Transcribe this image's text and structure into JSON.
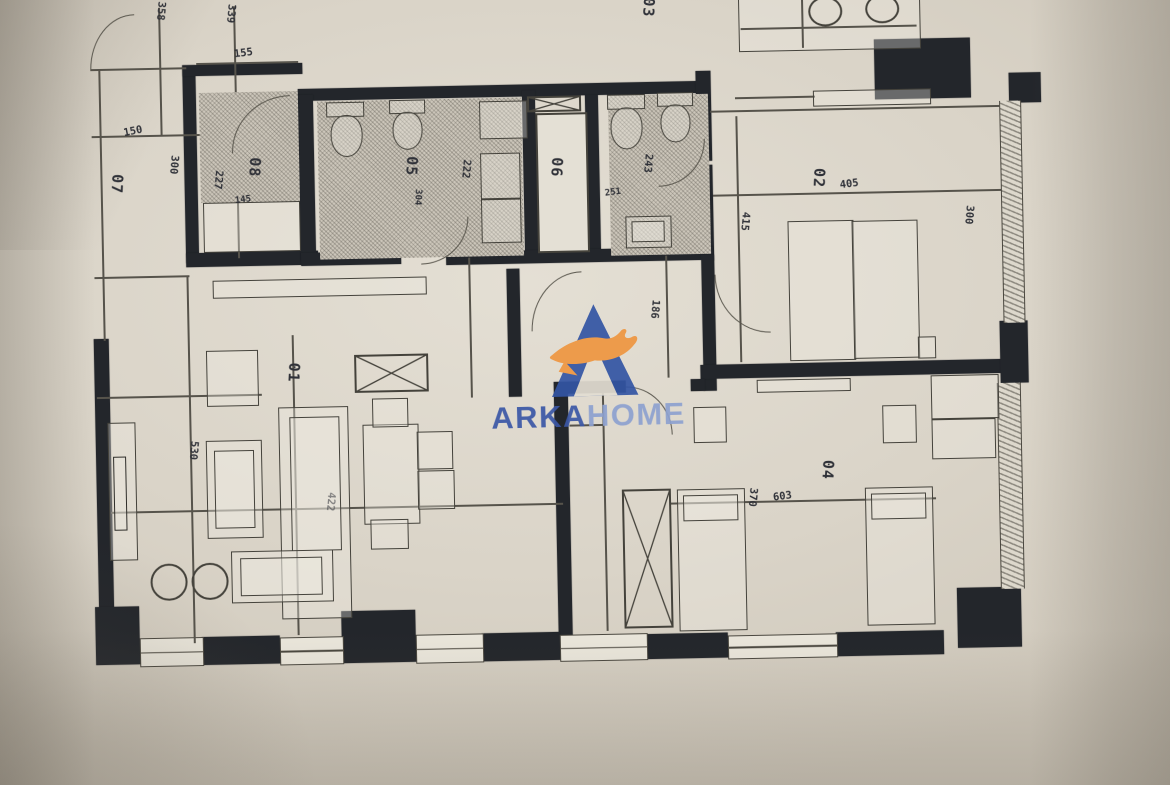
{
  "document_type": "apartment floor plan photo",
  "logo": {
    "word_primary": "ARKA",
    "word_secondary": "HOME",
    "colors": {
      "mark_blue": "#3355a4",
      "mark_orange": "#ef9640",
      "word_primary_blue": "#3b57a6",
      "word_secondary_blue": "#8da1d0"
    }
  },
  "rooms": {
    "r01": "01",
    "r02": "02",
    "r03": "03",
    "r04": "04",
    "r05": "05",
    "r06": "06",
    "r07": "07",
    "r08": "08"
  },
  "dimensions": {
    "d358": "358",
    "d339": "339",
    "d155": "155",
    "d150": "150",
    "d300a": "300",
    "d227": "227",
    "d145": "145",
    "d304": "304",
    "d222": "222",
    "d243": "243",
    "d251": "251",
    "d405": "405",
    "d415": "415",
    "d300b": "300",
    "d186": "186",
    "d530": "530",
    "d422": "422",
    "d603": "603",
    "d370": "370"
  },
  "palette": {
    "paper": "#dad4c8",
    "wall_ink": "#23262b",
    "line_ink": "#56534b"
  }
}
